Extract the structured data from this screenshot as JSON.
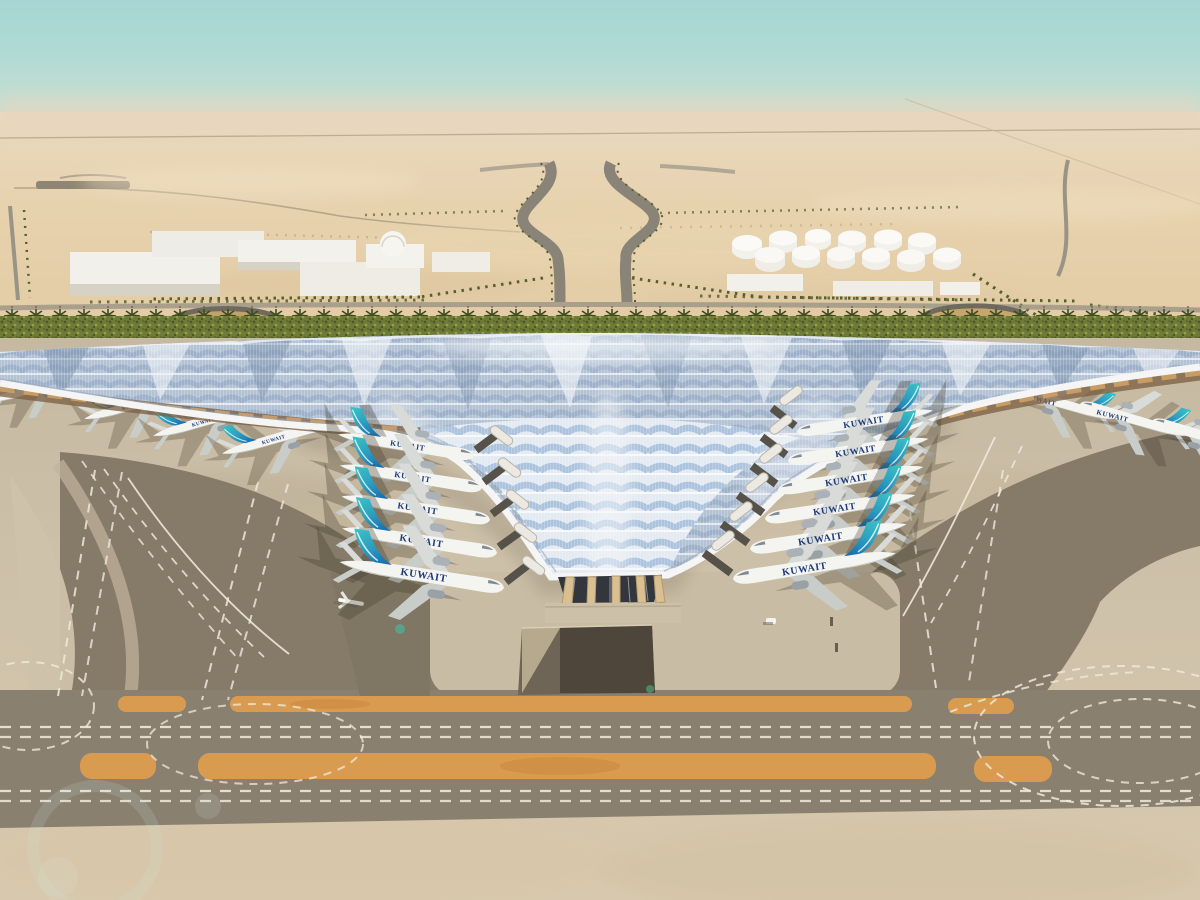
{
  "scene": {
    "airline_title": "KUWAIT",
    "aircraft": {
      "left_bay_count": 5,
      "right_bay_count": 6,
      "left_wing_count": 4,
      "right_wing_count": 4
    },
    "environment": {
      "fuel_tanks_count": 12,
      "warehouse_count": 6
    },
    "colors": {
      "sky_top": "#a6d6d3",
      "sky_horizon_haze": "#ead8bb",
      "desert_sand": "#e5cfa9",
      "apron_concrete": "#cfc2aa",
      "taxiway_dark": "#857b68",
      "taxiway_paint_orange": "#d99b50",
      "marking_white": "#efe9dc",
      "roof_silver": "#ccd6e2",
      "roof_blue": "#7da2cc",
      "roof_edge_white": "#f4f5f4",
      "canopy_amber": "#cfa066",
      "tail_teal": "#39c2c4",
      "tail_blue": "#1565ae",
      "fuselage_white": "#f4f4f1",
      "airline_text_navy": "#1e3a78",
      "foliage_green": "#6f7a38"
    }
  }
}
